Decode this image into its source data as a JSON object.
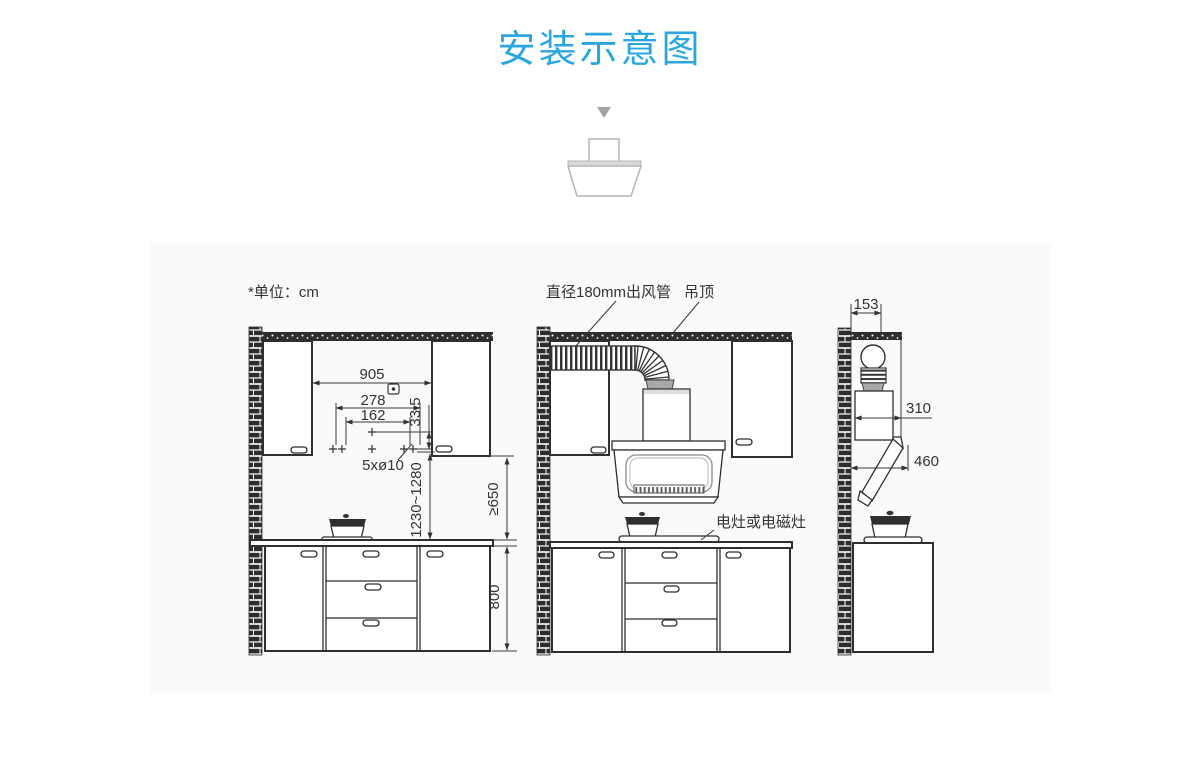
{
  "title": "安装示意图",
  "unit_note": "*单位：cm",
  "colors": {
    "accent": "#2BA7E0",
    "line": "#333333",
    "panel": "#FAFAFA"
  },
  "front_view": {
    "width_between_cabinets": "905",
    "hole_span_outer": "278",
    "hole_span_inner": "162",
    "hole_vertical_offset": "33.5",
    "holes_label": "5xø10",
    "install_height_range": "1230~1280",
    "min_clearance": "≥650",
    "counter_height": "800"
  },
  "duct_view": {
    "duct_label": "直径180mm出风管",
    "ceiling_label": "吊顶",
    "stove_label": "电灶或电磁灶"
  },
  "side_view": {
    "duct_offset": "153",
    "chimney_depth": "310",
    "hood_depth": "460"
  }
}
